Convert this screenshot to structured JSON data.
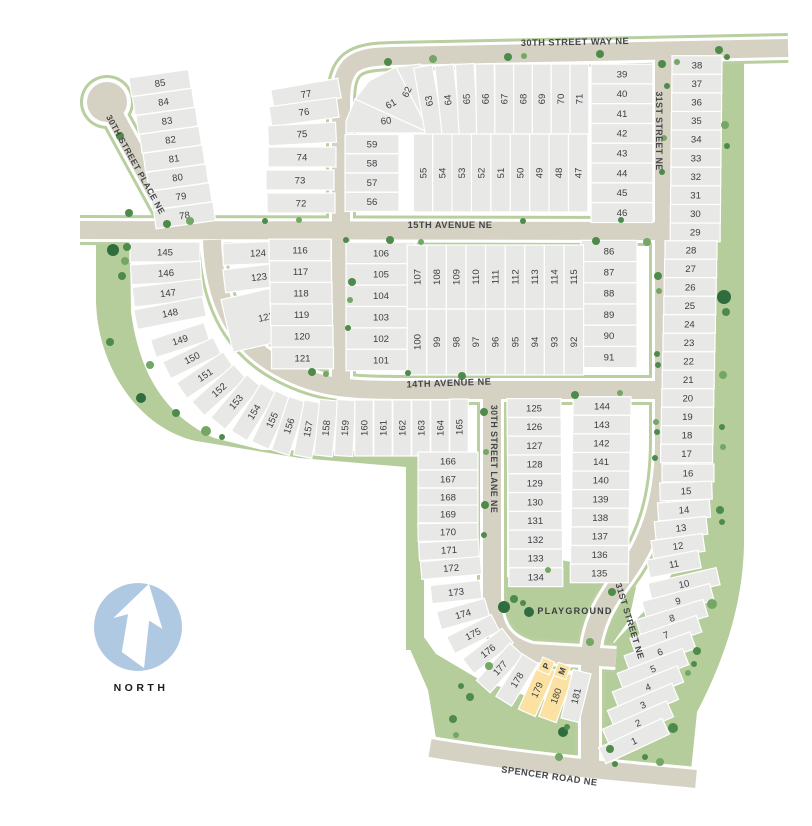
{
  "map_title": "subdivision plat map",
  "streets": {
    "way30": "30TH STREET WAY NE",
    "pl30": "30TH STREET PLACE NE",
    "st31_top": "31ST STREET NE",
    "st31_bottom": "31ST STREET NE",
    "ave15": "15TH AVENUE NE",
    "ave14": "14TH AVENUE NE",
    "lane30": "30TH STREET LANE NE",
    "spencer": "SPENCER ROAD NE"
  },
  "labels": {
    "playground": "PLAYGROUND",
    "north": "NORTH"
  },
  "markers": {
    "p": "P",
    "m": "M"
  },
  "highlighted_lots": [
    "179",
    "180"
  ],
  "lot_groups": {
    "g85_78": [
      "85",
      "84",
      "83",
      "82",
      "81",
      "80",
      "79",
      "78"
    ],
    "g77_72": [
      "77",
      "76",
      "75",
      "74",
      "73",
      "72"
    ],
    "g59_56": [
      "59",
      "58",
      "57",
      "56"
    ],
    "g60_62": [
      "60",
      "61",
      "62"
    ],
    "g63_71": [
      "63",
      "64",
      "65",
      "66",
      "67",
      "68",
      "69",
      "70",
      "71"
    ],
    "g39_46": [
      "39",
      "40",
      "41",
      "42",
      "43",
      "44",
      "45",
      "46"
    ],
    "g55_47": [
      "55",
      "54",
      "53",
      "52",
      "51",
      "50",
      "49",
      "48",
      "47"
    ],
    "g38_29": [
      "38",
      "37",
      "36",
      "35",
      "34",
      "33",
      "32",
      "31",
      "30",
      "29"
    ],
    "g28_17": [
      "28",
      "27",
      "26",
      "25",
      "24",
      "23",
      "22",
      "21",
      "20",
      "19",
      "18",
      "17"
    ],
    "g16_11": [
      "16",
      "15",
      "14",
      "13",
      "12",
      "11"
    ],
    "g10_1": [
      "10",
      "9",
      "8",
      "7",
      "6",
      "5",
      "4",
      "3",
      "2",
      "1"
    ],
    "g106_101": [
      "106",
      "105",
      "104",
      "103",
      "102",
      "101"
    ],
    "g86_91": [
      "86",
      "87",
      "88",
      "89",
      "90",
      "91"
    ],
    "g107_115": [
      "107",
      "108",
      "109",
      "110",
      "111",
      "112",
      "113",
      "114",
      "115"
    ],
    "g100_92": [
      "100",
      "99",
      "98",
      "97",
      "96",
      "95",
      "94",
      "93",
      "92"
    ],
    "g124_122": [
      "124",
      "123",
      "122"
    ],
    "g116_121": [
      "116",
      "117",
      "118",
      "119",
      "120",
      "121"
    ],
    "g145_148": [
      "145",
      "146",
      "147",
      "148"
    ],
    "g149_165": [
      "149",
      "150",
      "151",
      "152",
      "153",
      "154",
      "155",
      "156",
      "157",
      "158",
      "159",
      "160",
      "161",
      "162",
      "163",
      "164",
      "165"
    ],
    "g166_172": [
      "166",
      "167",
      "168",
      "169",
      "170",
      "171",
      "172"
    ],
    "g173_181": [
      "173",
      "174",
      "175",
      "176",
      "177",
      "178",
      "179",
      "180",
      "181"
    ],
    "g125_134": [
      "125",
      "126",
      "127",
      "128",
      "129",
      "130",
      "131",
      "132",
      "133",
      "134"
    ],
    "g144_135": [
      "144",
      "143",
      "142",
      "141",
      "140",
      "139",
      "138",
      "137",
      "136",
      "135"
    ]
  },
  "colors": {
    "background": "#ffffff",
    "lot": "#e8e8e6",
    "lot_line": "#ffffff",
    "road": "#d5d2c4",
    "verge": "#b9cfa0",
    "green": "#b5cc9b",
    "tree": "#4e8b4a",
    "tree_light": "#74a765",
    "tree_dark": "#2f6c3e",
    "highlight": "#fbe2a3",
    "text": "#3b3e42",
    "north_circle": "#b0c9e2"
  }
}
